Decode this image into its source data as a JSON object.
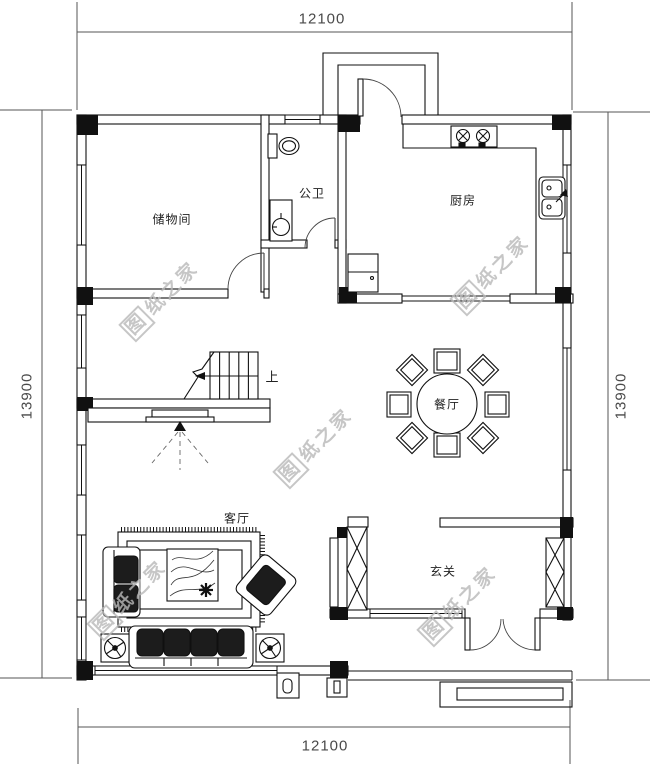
{
  "drawing": {
    "background_color": "#ffffff",
    "line_color": "#111111",
    "dim_color": "#4a4a4a",
    "watermark_color": "#b9b9b9"
  },
  "rooms": {
    "storage": "储物间",
    "bathroom": "公卫",
    "kitchen": "厨房",
    "dining": "餐厅",
    "living": "客厅",
    "foyer": "玄关"
  },
  "stairs": {
    "up_label": "上"
  },
  "dimensions": {
    "top": "12100",
    "bottom": "12100",
    "left": "13900",
    "right": "13900"
  },
  "watermark": {
    "boxed_char": "图",
    "rest": "纸之家",
    "full_text": "图纸之家"
  }
}
